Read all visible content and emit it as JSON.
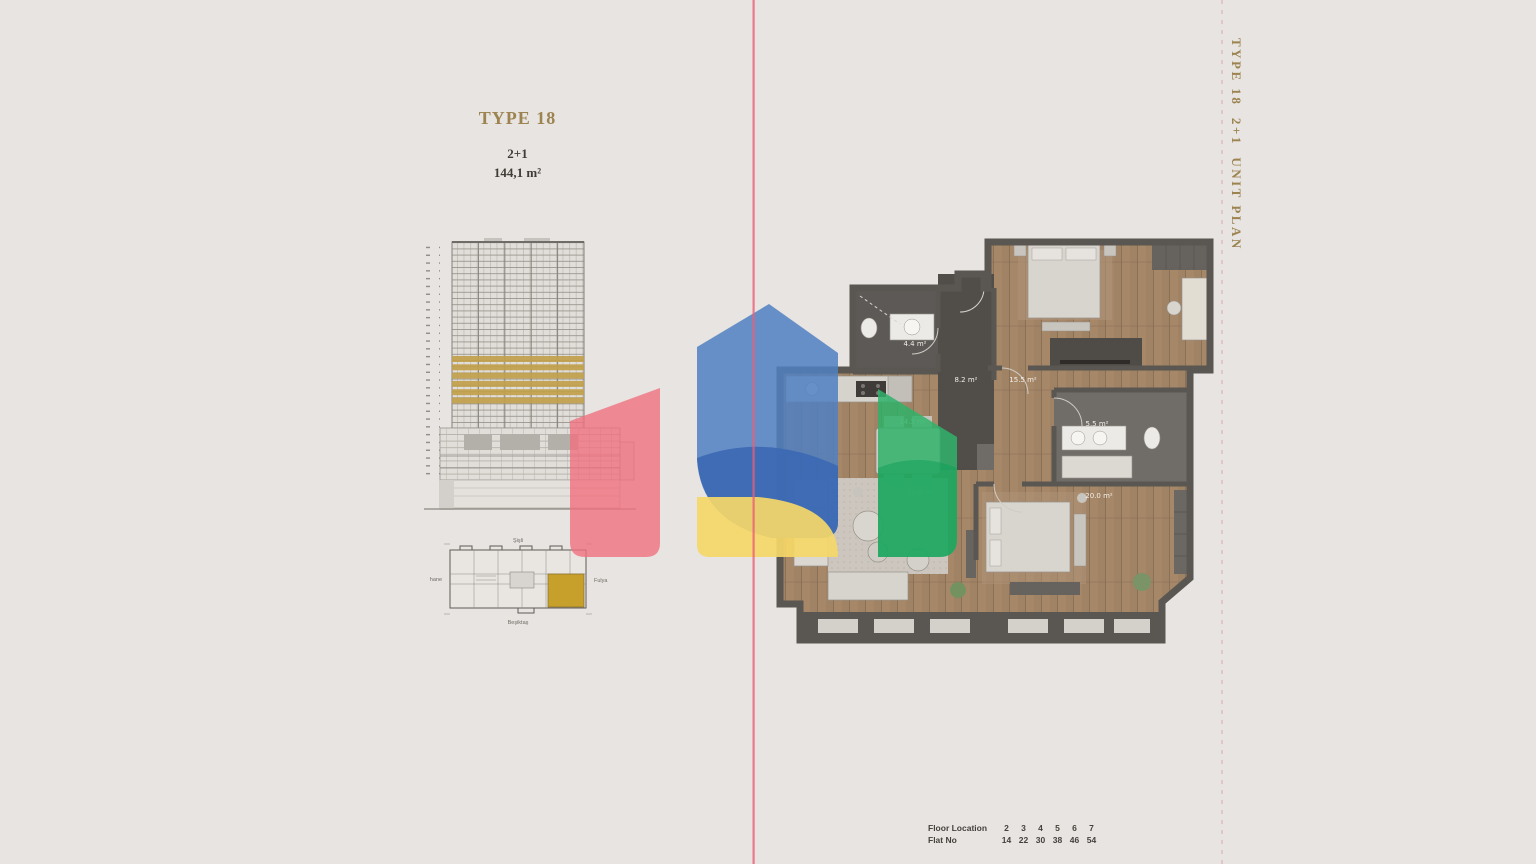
{
  "page": {
    "background_color": "#e7e4e1",
    "divider_line_color": "#ee5d76",
    "dashed_line_color": "#d9b3bc"
  },
  "header": {
    "type_title": "TYPE 18",
    "layout": "2+1",
    "area": "144,1 m²"
  },
  "side_label": "TYPE 18  2+1  UNIT PLAN",
  "elevation": {
    "highlight_color": "#c2a14c"
  },
  "key_plan": {
    "north_label": "Şişli",
    "east_label": "Fulya",
    "south_label": "Beşiktaş",
    "west_label": "Kağıthane",
    "highlight_color": "#c6a02b"
  },
  "floor_plan": {
    "rooms": [
      {
        "name": "bathroom",
        "area_label": "4.4 m²"
      },
      {
        "name": "entrance-hall",
        "area_label": "8.2 m²"
      },
      {
        "name": "hall",
        "area_label": "15.5 m²"
      },
      {
        "name": "bathroom-2",
        "area_label": "5.5 m²"
      },
      {
        "name": "kitchen-dining",
        "area_label": "14.3 m²"
      },
      {
        "name": "living-room",
        "area_label": "20.9 m²"
      },
      {
        "name": "bedroom",
        "area_label": "20.0 m²"
      }
    ]
  },
  "floor_table": {
    "floor_label": "Floor Location",
    "flat_label": "Flat No",
    "floors": [
      "2",
      "3",
      "4",
      "5",
      "6",
      "7"
    ],
    "flats": [
      "14",
      "22",
      "30",
      "38",
      "46",
      "54"
    ]
  },
  "watermark": {
    "blue": "#5080c2",
    "blue_dark": "#3b68b2",
    "red": "#f0717e",
    "yellow": "#f5d768",
    "green": "#2fb36a"
  }
}
